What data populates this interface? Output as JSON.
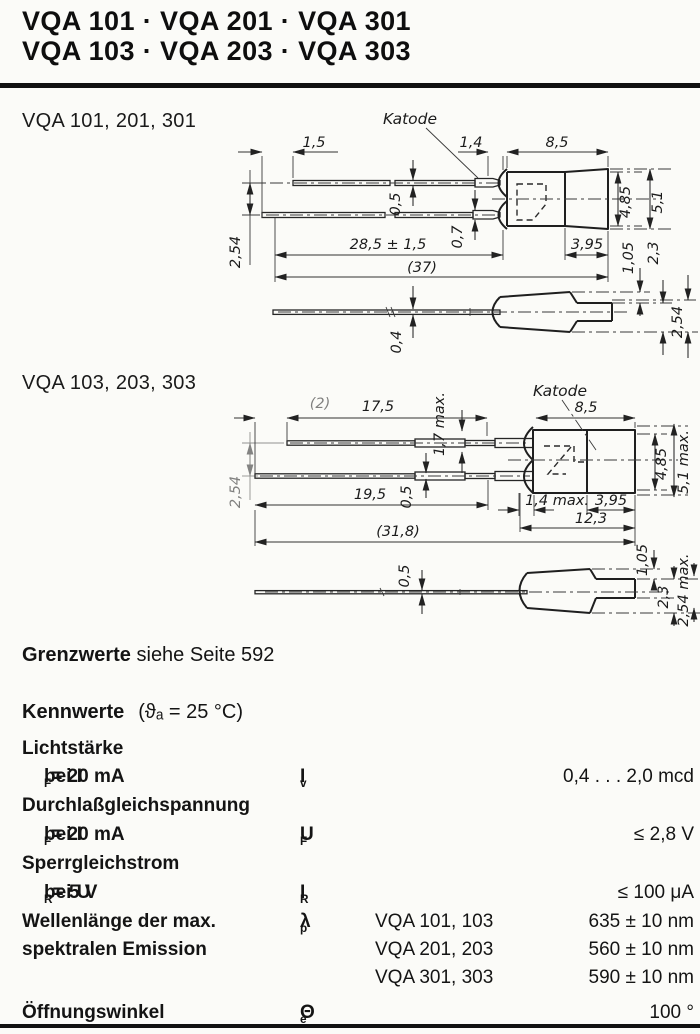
{
  "page": {
    "title_line1": "VQA 101 · VQA 201 · VQA 301",
    "title_line2": "VQA 103 · VQA 203 · VQA 303",
    "note_bold": "Grenzwerte",
    "note_rest": " siehe Seite 592"
  },
  "drawing1": {
    "label": "VQA 101, 201, 301",
    "katode": "Katode",
    "dim_1_5": "1,5",
    "dim_1_4": "1,4",
    "dim_8_5": "8,5",
    "dim_2_54_left": "2,54",
    "dim_0_5": "0,5",
    "dim_0_7": "0,7",
    "dim_28_5": "28,5 ± 1,5",
    "dim_37": "(37)",
    "dim_4_85": "4,85",
    "dim_5_1": "5,1",
    "dim_3_95": "3,95",
    "dim_1_05": "1,05",
    "dim_2_3": "2,3",
    "dim_2_54_right": "2,54",
    "dim_0_4": "0,4"
  },
  "drawing2": {
    "label": "VQA 103, 203, 303",
    "katode": "Katode",
    "dim_2": "(2)",
    "dim_17_5": "17,5",
    "dim_1_7": "1,7 max.",
    "dim_8_5": "8,5",
    "dim_2_54_left": "2,54",
    "dim_4_85": "4,85",
    "dim_5_1": "5,1 max.",
    "dim_19_5": "19,5",
    "dim_0_5_top": "0,5",
    "dim_1_4": "1,4 max.",
    "dim_3_95": "3,95",
    "dim_12_3": "12,3",
    "dim_31_8": "(31,8)",
    "dim_0_5_bottom": "0,5",
    "dim_1_05": "1,05",
    "dim_2_3": "2,3",
    "dim_2_54_right": "2,54 max."
  },
  "kennwerte": {
    "heading": "Kennwerte",
    "condition": "(ϑₐ = 25 °C)",
    "r1_name": "Lichtstärke",
    "r2_cond_pre": "bei I",
    "r2_cond_sub": "F",
    "r2_cond_post": " = 20 mA",
    "r2_sym": "I",
    "r2_sym_sub": "v",
    "r2_value": "0,4 . . . 2,0 mcd",
    "r3_name": "Durchlaßgleichspannung",
    "r4_cond_pre": "bei I",
    "r4_cond_sub": "F",
    "r4_cond_post": " = 20 mA",
    "r4_sym": "U",
    "r4_sym_sub": "F",
    "r4_value": "≤ 2,8 V",
    "r5_name": "Sperrgleichstrom",
    "r6_cond_pre": "bei U",
    "r6_cond_sub": "R",
    "r6_cond_post": " = 5 V",
    "r6_sym": "I",
    "r6_sym_sub": "R",
    "r6_value": "≤ 100 μA",
    "r7_name_line1": "Wellenlänge der max.",
    "r7_name_line2": "spektralen Emission",
    "r7_sym": "λ",
    "r7_sym_sub": "p",
    "r7_type1": "VQA 101, 103",
    "r7_value1": "635 ± 10 nm",
    "r7_type2": "VQA 201, 203",
    "r7_value2": "560 ± 10 nm",
    "r7_type3": "VQA 301, 303",
    "r7_value3": "590 ± 10 nm",
    "r8_name": "Öffnungswinkel",
    "r8_sym": "Θ",
    "r8_sym_sub": "e",
    "r8_value": "100 °"
  }
}
